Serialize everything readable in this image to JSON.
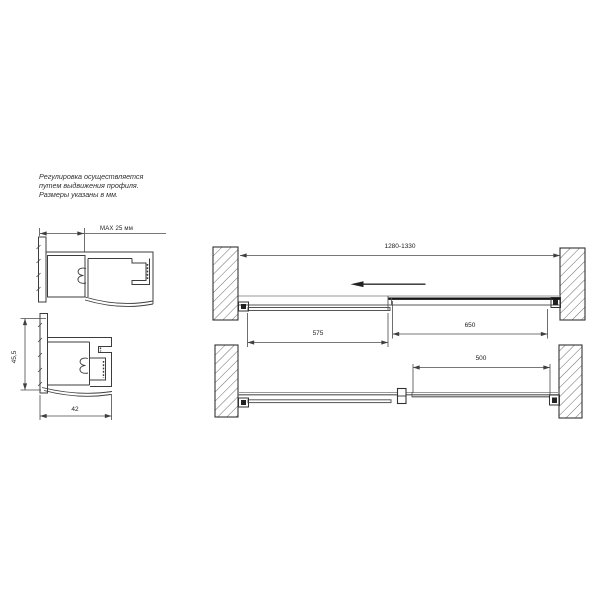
{
  "note": {
    "lines": [
      "Регулировка осуществляется",
      "путем выдвижения профиля.",
      "Размеры указаны в мм."
    ]
  },
  "profile_sections": {
    "max_extension_label": "MAX 25 мм",
    "height_label": "45,5",
    "width_label": "42"
  },
  "plan_views": {
    "closed": {
      "total_width_label": "1280-1330",
      "sliding_panel_label": "575",
      "fixed_panel_label": "650"
    },
    "open": {
      "opening_label": "500"
    }
  },
  "colors": {
    "line": "#3c3c3c",
    "dim": "#4a4a4a",
    "wall_hatch": "#5a5a5a",
    "text": "#1c1c1c"
  }
}
